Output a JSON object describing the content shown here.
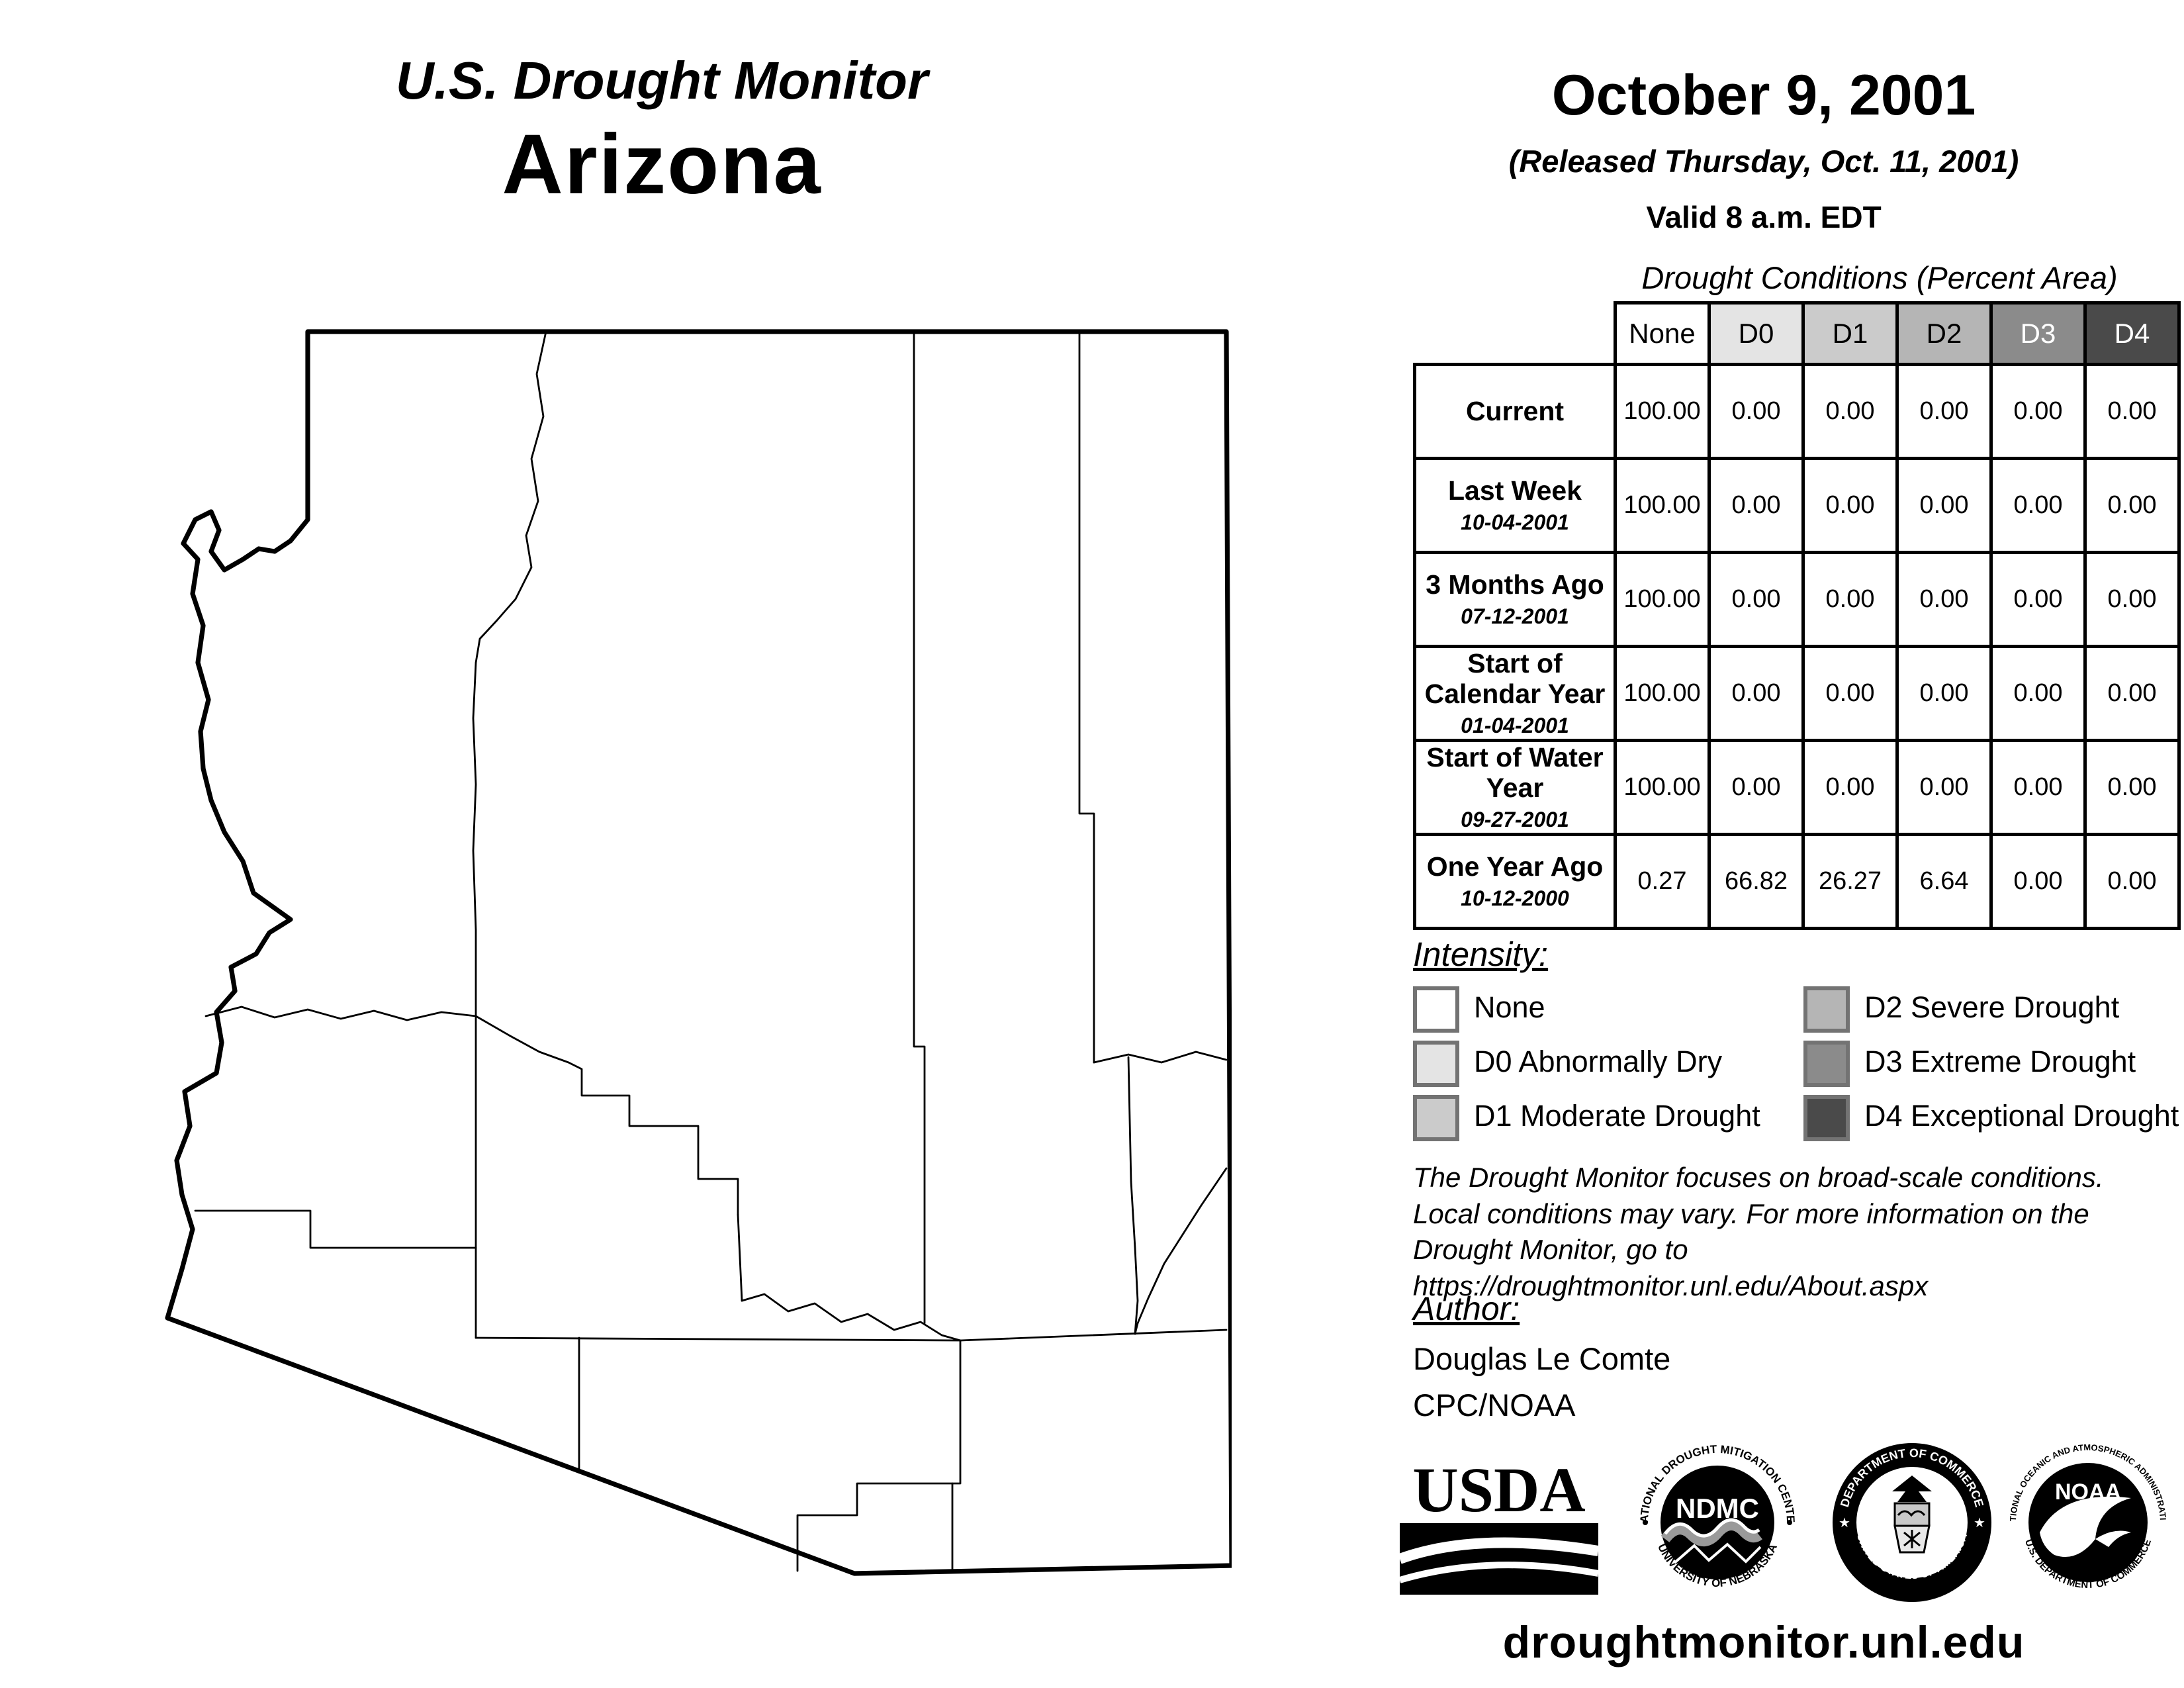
{
  "header_left": {
    "supertitle": "U.S. Drought Monitor",
    "title": "Arizona"
  },
  "header_right": {
    "date": "October 9, 2001",
    "released": "(Released Thursday, Oct. 11, 2001)",
    "valid": "Valid 8 a.m. EDT"
  },
  "table": {
    "caption": "Drought Conditions (Percent Area)",
    "columns": [
      {
        "label": "None",
        "bg": "#ffffff",
        "fg": "#000000"
      },
      {
        "label": "D0",
        "bg": "#e4e4e4",
        "fg": "#000000"
      },
      {
        "label": "D1",
        "bg": "#cbcbcb",
        "fg": "#000000"
      },
      {
        "label": "D2",
        "bg": "#b5b5b5",
        "fg": "#000000"
      },
      {
        "label": "D3",
        "bg": "#8b8b8b",
        "fg": "#ffffff"
      },
      {
        "label": "D4",
        "bg": "#4a4a4a",
        "fg": "#ffffff"
      }
    ],
    "rows": [
      {
        "label": "Current",
        "date": "",
        "values": [
          "100.00",
          "0.00",
          "0.00",
          "0.00",
          "0.00",
          "0.00"
        ]
      },
      {
        "label": "Last Week",
        "date": "10-04-2001",
        "values": [
          "100.00",
          "0.00",
          "0.00",
          "0.00",
          "0.00",
          "0.00"
        ]
      },
      {
        "label": "3 Months Ago",
        "date": "07-12-2001",
        "values": [
          "100.00",
          "0.00",
          "0.00",
          "0.00",
          "0.00",
          "0.00"
        ]
      },
      {
        "label": "Start of Calendar Year",
        "date": "01-04-2001",
        "values": [
          "100.00",
          "0.00",
          "0.00",
          "0.00",
          "0.00",
          "0.00"
        ]
      },
      {
        "label": "Start of Water Year",
        "date": "09-27-2001",
        "values": [
          "100.00",
          "0.00",
          "0.00",
          "0.00",
          "0.00",
          "0.00"
        ]
      },
      {
        "label": "One Year Ago",
        "date": "10-12-2000",
        "values": [
          "0.27",
          "66.82",
          "26.27",
          "6.64",
          "0.00",
          "0.00"
        ]
      }
    ]
  },
  "legend": {
    "title": "Intensity:",
    "items": [
      {
        "label": "None",
        "color": "#ffffff"
      },
      {
        "label": "D0 Abnormally Dry",
        "color": "#e4e4e4"
      },
      {
        "label": "D1 Moderate Drought",
        "color": "#cbcbcb"
      },
      {
        "label": "D2 Severe Drought",
        "color": "#b5b5b5"
      },
      {
        "label": "D3 Extreme Drought",
        "color": "#8b8b8b"
      },
      {
        "label": "D4 Exceptional Drought",
        "color": "#4a4a4a"
      }
    ]
  },
  "disclaimer": {
    "line1": "The Drought Monitor focuses on broad-scale conditions.",
    "line2": "Local conditions may vary. For more information on the",
    "line3": "Drought Monitor, go to https://droughtmonitor.unl.edu/About.aspx"
  },
  "author": {
    "heading": "Author:",
    "name": "Douglas Le Comte",
    "org": "CPC/NOAA"
  },
  "logos": {
    "usda": "USDA",
    "ndmc_center": "NDMC",
    "ndmc_top": "NATIONAL DROUGHT MITIGATION CENTER",
    "ndmc_bottom": "UNIVERSITY OF NEBRASKA",
    "doc_top": "DEPARTMENT OF COMMERCE",
    "doc_bottom": "UNITED STATES OF AMERICA",
    "noaa_center": "NOAA",
    "noaa_top": "NATIONAL OCEANIC AND ATMOSPHERIC ADMINISTRATION",
    "noaa_bottom": "U.S. DEPARTMENT OF COMMERCE"
  },
  "footer": {
    "url": "droughtmonitor.unl.edu"
  }
}
